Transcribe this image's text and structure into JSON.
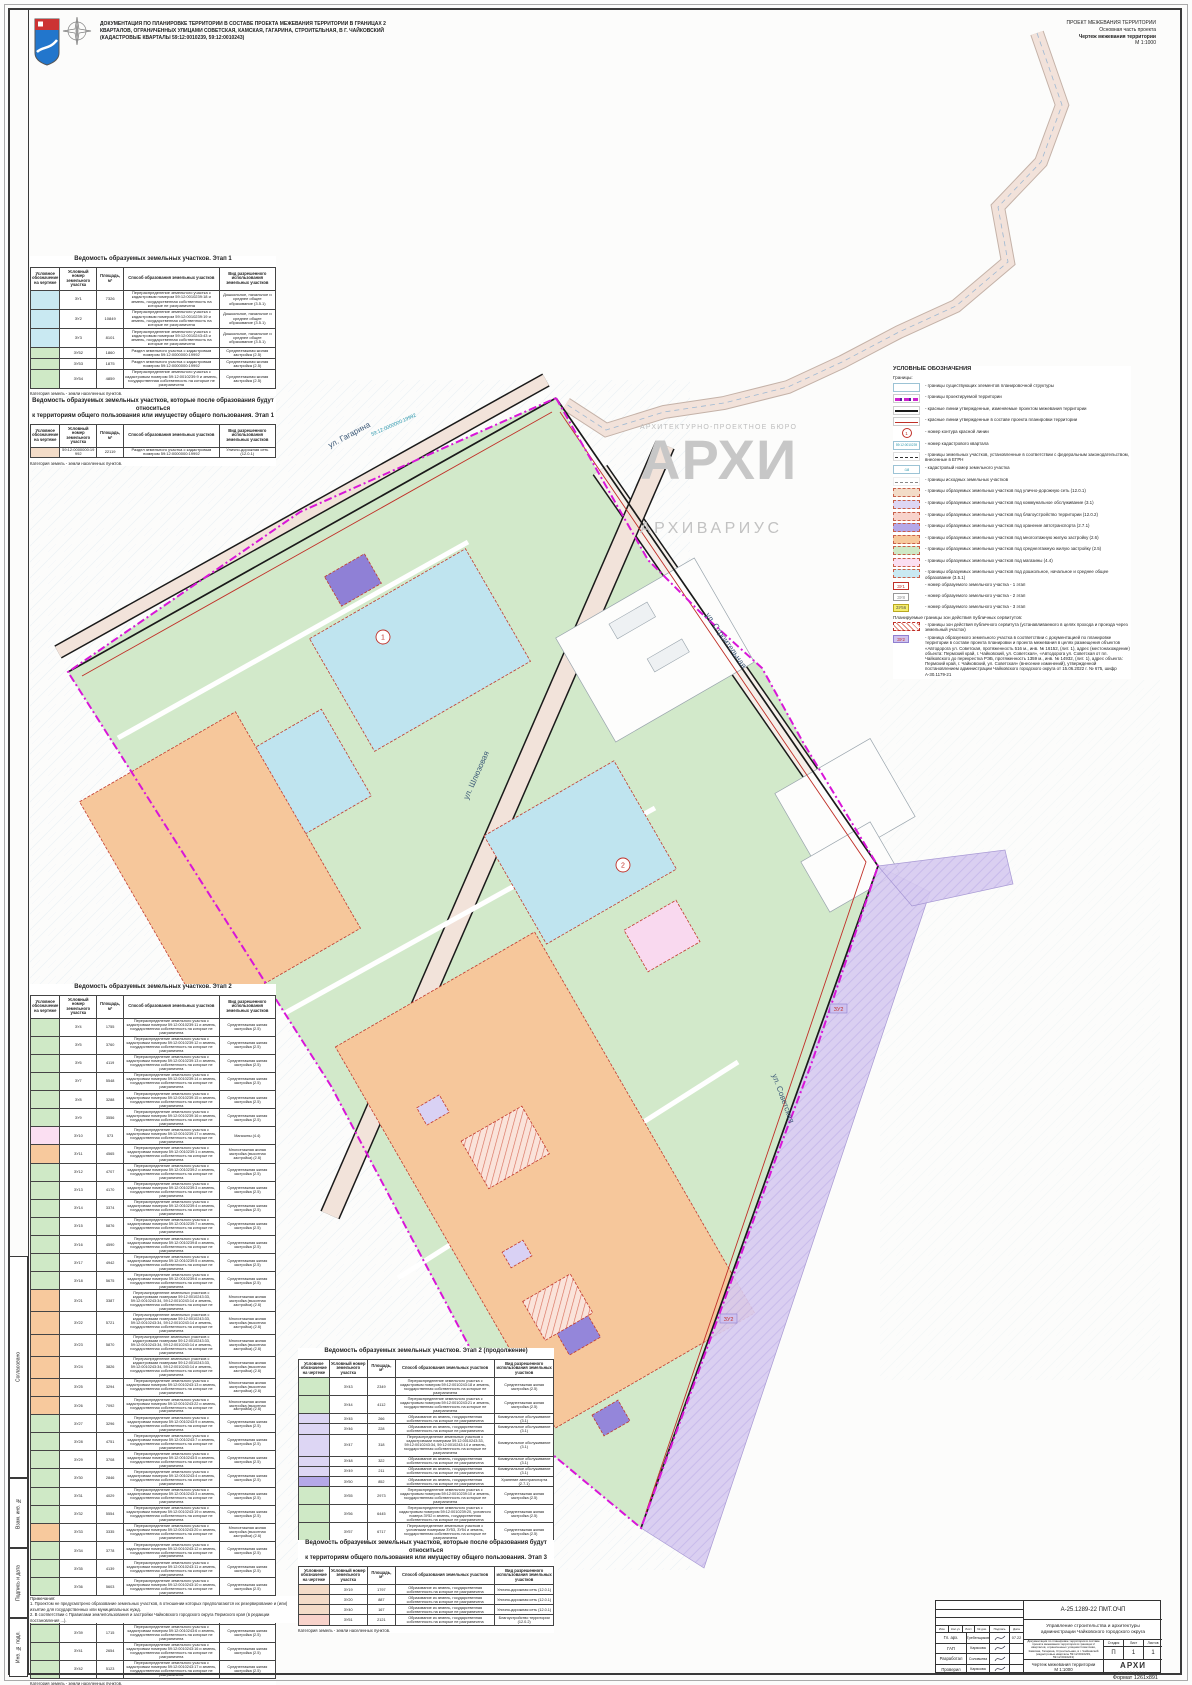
{
  "header": {
    "title": "ДОКУМЕНТАЦИЯ ПО ПЛАНИРОВКЕ ТЕРРИТОРИИ В СОСТАВЕ ПРОЕКТА МЕЖЕВАНИЯ ТЕРРИТОРИИ В ГРАНИЦАХ 2\nКВАРТАЛОВ, ОГРАНИЧЕННЫХ УЛИЦАМИ СОВЕТСКАЯ, КАМСКАЯ, ГАГАРИНА, СТРОИТЕЛЬНАЯ, В Г. ЧАЙКОВСКИЙ\n(КАДАСТРОВЫЕ КВАРТАЛЫ 59:12:0010239, 59:12:0010243)",
    "right1": "ПРОЕКТ МЕЖЕВАНИЯ ТЕРРИТОРИИ",
    "right2": "Основная часть проекта",
    "right3": "Чертеж межевания территории",
    "right4": "М 1:1000"
  },
  "watermark": {
    "bureau": "АРХИТЕКТУРНО-ПРОЕКТНОЕ БЮРО",
    "big": "АРХИ",
    "name": "АРХИВАРИУС"
  },
  "columns": [
    "Условное обозначение на чертеже",
    "Условный номер земельного участка",
    "Площадь, м²",
    "Способ образования земельных участков",
    "Вид разрешенного использования земельных участков"
  ],
  "method_templates": {
    "A": "Перераспределение земельного участка с кадастровым номером {kn} и земель, государственная собственность на которые не разграничена",
    "B": "Перераспределение земельных участков с кадастровыми номерами 59:12:0010243:33, 59:12:0010243:34, 59:12:0010243:14 и земель, государственная собственность на которые не разграничена",
    "C": "Образование из земель, государственная собственность на которые не разграничена",
    "D": "Раздел земельного участка с кадастровым номером 59:12:0000000:19992",
    "E": "Перераспределение земельного участка с кадастровым номером 59:12:0010239:20, условного номера ЗУ52 и земель, государственная собственность на которые не разграничена",
    "F": "Перераспределение земельных участков с условными номерами ЗУ53, ЗУ54 и земель, государственная собственность на которые не разграничена"
  },
  "uses": {
    "u1": "Дошкольное, начальное и среднее общее образование (3.5.1)",
    "u2": "Среднеэтажная жилая застройка (2.5)",
    "u3": "Улично-дорожная сеть (12.0.1)",
    "u4": "Магазины (4.4)",
    "u5": "Многоэтажная жилая застройка (высотная застройка) (2.6)",
    "u6": "Коммунальное обслуживание (3.1)",
    "u7": "Хранение автотранспорта (2.7.1)",
    "u8": "Благоустройство территории (12.0.2)"
  },
  "colors": {
    "cyan": "#c9e9f2",
    "green": "#cfe9c6",
    "orange": "#f7c99d",
    "lavender": "#ddd6f4",
    "purple": "#b5a8e8",
    "magenta": "#fbdff2",
    "tan": "#f3dcc8",
    "red": "#f8d3cb"
  },
  "tables": [
    {
      "title": "Ведомость образуемых земельных участков. Этап 1",
      "footer": "Категория земель - земли населенных пунктов.",
      "rows": [
        {
          "c": "cyan",
          "id": "ЗУ1",
          "a": "7326",
          "m": "A",
          "kn": "59:12:0010239:18",
          "u": "u1"
        },
        {
          "c": "cyan",
          "id": "ЗУ2",
          "a": "10849",
          "m": "A",
          "kn": "59:12:0010239:19",
          "u": "u1"
        },
        {
          "c": "cyan",
          "id": "ЗУ3",
          "a": "8101",
          "m": "A",
          "kn": "59:12:0010243:43",
          "u": "u1"
        },
        {
          "c": "green",
          "id": "ЗУ52",
          "a": "1860",
          "m": "D",
          "u": "u2"
        },
        {
          "c": "green",
          "id": "ЗУ53",
          "a": "1875",
          "m": "D",
          "u": "u2"
        },
        {
          "c": "green",
          "id": "ЗУ54",
          "a": "4859",
          "m": "A",
          "kn": "59:12:0010239:9",
          "u": "u2"
        }
      ]
    },
    {
      "title": "Ведомость образуемых земельных участков, которые после образования будут относиться\nк территориям общего пользования или имуществу общего пользования. Этап 1",
      "footer": "Категория земель - земли населенных пунктов.",
      "rows": [
        {
          "c": "tan",
          "id": "59:12:0000000:19992",
          "a": "22119",
          "m": "D",
          "u": "u3"
        }
      ]
    },
    {
      "title": "Ведомость образуемых земельных участков. Этап 2",
      "footer": "Категория земель - земли населенных пунктов.",
      "rows": [
        {
          "c": "green",
          "id": "ЗУ4",
          "a": "1755",
          "m": "A",
          "kn": "59:12:0010239:11",
          "u": "u2"
        },
        {
          "c": "green",
          "id": "ЗУ5",
          "a": "3760",
          "m": "A",
          "kn": "59:12:0010239:12",
          "u": "u2"
        },
        {
          "c": "green",
          "id": "ЗУ6",
          "a": "4119",
          "m": "A",
          "kn": "59:12:0010239:13",
          "u": "u2"
        },
        {
          "c": "green",
          "id": "ЗУ7",
          "a": "5548",
          "m": "A",
          "kn": "59:12:0010239:14",
          "u": "u2"
        },
        {
          "c": "green",
          "id": "ЗУ8",
          "a": "3288",
          "m": "A",
          "kn": "59:12:0010239:15",
          "u": "u2"
        },
        {
          "c": "green",
          "id": "ЗУ9",
          "a": "3556",
          "m": "A",
          "kn": "59:12:0010239:16",
          "u": "u2"
        },
        {
          "c": "magenta",
          "id": "ЗУ10",
          "a": "573",
          "m": "A",
          "kn": "59:12:0010239:17",
          "u": "u4"
        },
        {
          "c": "orange",
          "id": "ЗУ11",
          "a": "4565",
          "m": "A",
          "kn": "59:12:0010239:1",
          "u": "u5"
        },
        {
          "c": "green",
          "id": "ЗУ12",
          "a": "4707",
          "m": "A",
          "kn": "59:12:0010239:2",
          "u": "u2"
        },
        {
          "c": "green",
          "id": "ЗУ13",
          "a": "4170",
          "m": "A",
          "kn": "59:12:0010239:3",
          "u": "u2"
        },
        {
          "c": "green",
          "id": "ЗУ14",
          "a": "3374",
          "m": "A",
          "kn": "59:12:0010239:4",
          "u": "u2"
        },
        {
          "c": "green",
          "id": "ЗУ15",
          "a": "5876",
          "m": "A",
          "kn": "59:12:0010239:7",
          "u": "u2"
        },
        {
          "c": "green",
          "id": "ЗУ16",
          "a": "4590",
          "m": "A",
          "kn": "59:12:0010239:8",
          "u": "u2"
        },
        {
          "c": "green",
          "id": "ЗУ17",
          "a": "4942",
          "m": "A",
          "kn": "59:12:0010239:5",
          "u": "u2"
        },
        {
          "c": "green",
          "id": "ЗУ18",
          "a": "5675",
          "m": "A",
          "kn": "59:12:0010239:6",
          "u": "u2"
        },
        {
          "c": "orange",
          "id": "ЗУ21",
          "a": "3387",
          "m": "B",
          "u": "u5"
        },
        {
          "c": "orange",
          "id": "ЗУ22",
          "a": "5721",
          "m": "B",
          "u": "u5"
        },
        {
          "c": "orange",
          "id": "ЗУ23",
          "a": "5870",
          "m": "B",
          "u": "u5"
        },
        {
          "c": "orange",
          "id": "ЗУ24",
          "a": "3826",
          "m": "B",
          "u": "u5"
        },
        {
          "c": "orange",
          "id": "ЗУ25",
          "a": "3294",
          "m": "A",
          "kn": "59:12:0010243:13",
          "u": "u5"
        },
        {
          "c": "orange",
          "id": "ЗУ26",
          "a": "7092",
          "m": "A",
          "kn": "59:12:0010243:22",
          "u": "u5"
        },
        {
          "c": "green",
          "id": "ЗУ27",
          "a": "3296",
          "m": "A",
          "kn": "59:12:0010243:9",
          "u": "u2"
        },
        {
          "c": "green",
          "id": "ЗУ28",
          "a": "4751",
          "m": "A",
          "kn": "59:12:0010243:7",
          "u": "u2"
        },
        {
          "c": "green",
          "id": "ЗУ29",
          "a": "3708",
          "m": "A",
          "kn": "59:12:0010243:5",
          "u": "u2"
        },
        {
          "c": "green",
          "id": "ЗУ30",
          "a": "2846",
          "m": "A",
          "kn": "59:12:0010243:4",
          "u": "u2"
        },
        {
          "c": "green",
          "id": "ЗУ31",
          "a": "4029",
          "m": "A",
          "kn": "59:12:0010243:3",
          "u": "u2"
        },
        {
          "c": "green",
          "id": "ЗУ32",
          "a": "5554",
          "m": "A",
          "kn": "59:12:0010243:19",
          "u": "u2"
        },
        {
          "c": "orange",
          "id": "ЗУ33",
          "a": "3335",
          "m": "A",
          "kn": "59:12:0010243:20",
          "u": "u5"
        },
        {
          "c": "green",
          "id": "ЗУ34",
          "a": "3778",
          "m": "A",
          "kn": "59:12:0010243:12",
          "u": "u2"
        },
        {
          "c": "green",
          "id": "ЗУ35",
          "a": "4139",
          "m": "A",
          "kn": "59:12:0010243:11",
          "u": "u2"
        },
        {
          "c": "green",
          "id": "ЗУ36",
          "a": "5603",
          "m": "A",
          "kn": "59:12:0010243:10",
          "u": "u2"
        },
        {
          "c": "lavender",
          "id": "ЗУ37",
          "a": "170",
          "m": "C",
          "u": "u6"
        },
        {
          "c": "green",
          "id": "ЗУ38",
          "a": "4622",
          "m": "A",
          "kn": "59:12:0010243:8",
          "u": "u2"
        },
        {
          "c": "green",
          "id": "ЗУ39",
          "a": "1715",
          "m": "A",
          "kn": "59:12:0010243:6",
          "u": "u2"
        },
        {
          "c": "green",
          "id": "ЗУ41",
          "a": "2654",
          "m": "A",
          "kn": "59:12:0010243:16",
          "u": "u2"
        },
        {
          "c": "green",
          "id": "ЗУ42",
          "a": "5123",
          "m": "A",
          "kn": "59:12:0010243:17",
          "u": "u2"
        }
      ]
    },
    {
      "title": "Ведомость образуемых земельных участков. Этап 2 (продолжение)",
      "footer": "Категория земель - земли населенных пунктов.",
      "rows": [
        {
          "c": "green",
          "id": "ЗУ43",
          "a": "2349",
          "m": "A",
          "kn": "59:12:0010243:18",
          "u": "u2"
        },
        {
          "c": "green",
          "id": "ЗУ44",
          "a": "4112",
          "m": "A",
          "kn": "59:12:0010243:21",
          "u": "u2"
        },
        {
          "c": "lavender",
          "id": "ЗУ45",
          "a": "266",
          "m": "C",
          "u": "u6"
        },
        {
          "c": "lavender",
          "id": "ЗУ46",
          "a": "228",
          "m": "C",
          "u": "u6"
        },
        {
          "c": "lavender",
          "id": "ЗУ47",
          "a": "318",
          "m": "B",
          "u": "u6"
        },
        {
          "c": "lavender",
          "id": "ЗУ48",
          "a": "322",
          "m": "C",
          "u": "u6"
        },
        {
          "c": "lavender",
          "id": "ЗУ49",
          "a": "211",
          "m": "C",
          "u": "u6"
        },
        {
          "c": "purple",
          "id": "ЗУ50",
          "a": "852",
          "m": "C",
          "u": "u7"
        },
        {
          "c": "green",
          "id": "ЗУ55",
          "a": "2973",
          "m": "A",
          "kn": "59:12:0010239:10",
          "u": "u2"
        },
        {
          "c": "green",
          "id": "ЗУ56",
          "a": "6445",
          "m": "E",
          "u": "u2"
        },
        {
          "c": "green",
          "id": "ЗУ57",
          "a": "6717",
          "m": "F",
          "u": "u2"
        }
      ]
    },
    {
      "title": "Ведомость образуемых земельных участков, которые после образования будут относиться\nк территориям общего пользования или имуществу общего пользования. Этап 3",
      "footer": "Категория земель - земли населенных пунктов.",
      "rows": [
        {
          "c": "tan",
          "id": "ЗУ19",
          "a": "1797",
          "m": "C",
          "u": "u3"
        },
        {
          "c": "tan",
          "id": "ЗУ20",
          "a": "887",
          "m": "C",
          "u": "u3"
        },
        {
          "c": "tan",
          "id": "ЗУ40",
          "a": "167",
          "m": "C",
          "u": "u3"
        },
        {
          "c": "red",
          "id": "ЗУ51",
          "a": "2121",
          "m": "C",
          "u": "u8"
        }
      ]
    }
  ],
  "notes": "Примечания:\n1. Проектом не предусмотрено образование земельных участков, в отношении которых предполагаются их резервирование и (или) изъятие для государственных или муниципальных нужд.\n2. В соответствии с Правилами землепользования и застройки Чайковского городского округа Пермского края (в редакции постановления ...).",
  "legend": {
    "title": "УСЛОВНЫЕ ОБОЗНАЧЕНИЯ",
    "items": [
      {
        "t": "plain",
        "label": "Границы:"
      },
      {
        "t": "line-exist",
        "label": "- границы существующих элементов планировочной структуры"
      },
      {
        "t": "line-project",
        "label": "- границы проектируемой территории"
      },
      {
        "t": "line-rednew",
        "label": "- красные линии утвержденные, изменяемые проектом межевания территории"
      },
      {
        "t": "line-redold",
        "label": "- красные линии утвержденные в составе проекта планировки территории"
      },
      {
        "t": "circ",
        "tag": "1",
        "label": "- номер контура красной линии"
      },
      {
        "t": "kv",
        "tag": "59:12:0010239",
        "label": "- номер кадастрового квартала"
      },
      {
        "t": "dash-egrn",
        "label": "- границы земельных участков, установленные в соответствии с федеральным законодательством, внесенные в ЕГРН"
      },
      {
        "t": "kn",
        "tag": ":18",
        "label": "- кадастровый номер земельного участка"
      },
      {
        "t": "dash-src",
        "label": "- границы исходных земельных участков"
      },
      {
        "t": "fill-uds",
        "label": "- границы образуемых земельных участков под улично-дорожную сеть (12.0.1)"
      },
      {
        "t": "fill-kommun",
        "label": "- границы образуемых земельных участков под коммунальное обслуживание (3.1)"
      },
      {
        "t": "fill-blag",
        "label": "- границы образуемых земельных участков под благоустройство территории (12.0.2)"
      },
      {
        "t": "fill-auto",
        "label": "- границы образуемых земельных участков под хранение автотранспорта (2.7.1)"
      },
      {
        "t": "fill-mnogo",
        "label": "- границы образуемых земельных участков под многоэтажную жилую застройку (2.6)"
      },
      {
        "t": "fill-sredne",
        "label": "- границы образуемых земельных участков под среднеэтажную жилую застройку (2.5)"
      },
      {
        "t": "fill-mag",
        "label": "- границы образуемых земельных участков под магазины (4.4)"
      },
      {
        "t": "fill-obr",
        "label": "- границы образуемых земельных участков под дошкольное, начальное и среднее общее образование (3.5.1)"
      },
      {
        "t": "zu-red",
        "tag": "ЗУ1",
        "label": "- номер образуемого земельного участка - 1 этап"
      },
      {
        "t": "zu-gray",
        "tag": "ЗУ8",
        "label": "- номер образуемого земельного участка - 2 этап"
      },
      {
        "t": "zu-yellow",
        "tag": "ЗУ56",
        "label": "- номер образуемого земельного участка - 3 этап"
      },
      {
        "t": "plain",
        "label": "Планируемые границы зон действия публичных сервитутов:"
      },
      {
        "t": "hatch",
        "label": "- границы зон действия публичного сервитута (устанавливаемого в целях прохода и проезда через земельный участок)"
      },
      {
        "t": "zu-lav",
        "tag": "ЗУ2",
        "label": "- граница образуемого земельного участка в соответствии с документацией по планировке территории в составе проекта планировки и проекта межевания в целях размещения объектов «Автодорога ул. Советская, протяженность 516 м., инв. № 16152, (лит. 1), адрес (местонахождение) объекта: Пермский край, г. Чайковский, ул. Советская», «Автодорога ул. Советская от пл. Чайковского до перекрестка РЭБ, протяженность 1359 м., инв. № 14932, (лит. 1), адрес объекта: Пермский край, г. Чайковский, ул. Советская» (внесение изменений), утвержденной постановлением администрации Чайковского городского округа от 15.06.2022 г. № 675, шифр А-30.1179-21"
      }
    ]
  },
  "map": {
    "streets": [
      "ул. Гагарина",
      "ул. Шлюзовая",
      "ул. Строительная",
      "ул. Советская"
    ],
    "contours": [
      "1",
      "2"
    ],
    "cad_label": "59:12:0000000:19992",
    "servitude_tag": "ЗУ2"
  },
  "title_block": {
    "doc_number": "А-25.1289-22 ПМТ.ОЧП",
    "org": "Управление строительства и архитектуры администрации Чайковского городского округа",
    "desc": "Документация по планировке территории в составе проекта межевания территории в границах 2 кварталов, ограниченных улицами Советская, Камская, Гагарина, Строительная, в г. Чайковский (кадастровые кварталы 59:12:0010239, 59:12:0010243)",
    "sheet_title": "Чертеж межевания территории\nМ 1:1000",
    "stage_label": "Стадия",
    "stage": "П",
    "sheet_label": "Лист",
    "sheet": "1",
    "sheets_label": "Листов",
    "sheets": "1",
    "cols": [
      "Изм.",
      "Кол.уч",
      "Лист",
      "№ док.",
      "Подпись",
      "Дата"
    ],
    "roles": [
      {
        "role": "Гл. арх.",
        "name": "Гребенщиков",
        "date": "07.22"
      },
      {
        "role": "ГАП",
        "name": "Карякова",
        "date": ""
      },
      {
        "role": "Разработал",
        "name": "Соловьева",
        "date": ""
      },
      {
        "role": "Проверил",
        "name": "Карякова",
        "date": ""
      }
    ],
    "logo_big": "АРХИ",
    "logo_small": "архивариус"
  },
  "side_stamps": [
    "Согласовано",
    "Взам. инв. №",
    "Подпись и дата",
    "Инв. № подл."
  ],
  "format_label": "Формат 1261х891"
}
